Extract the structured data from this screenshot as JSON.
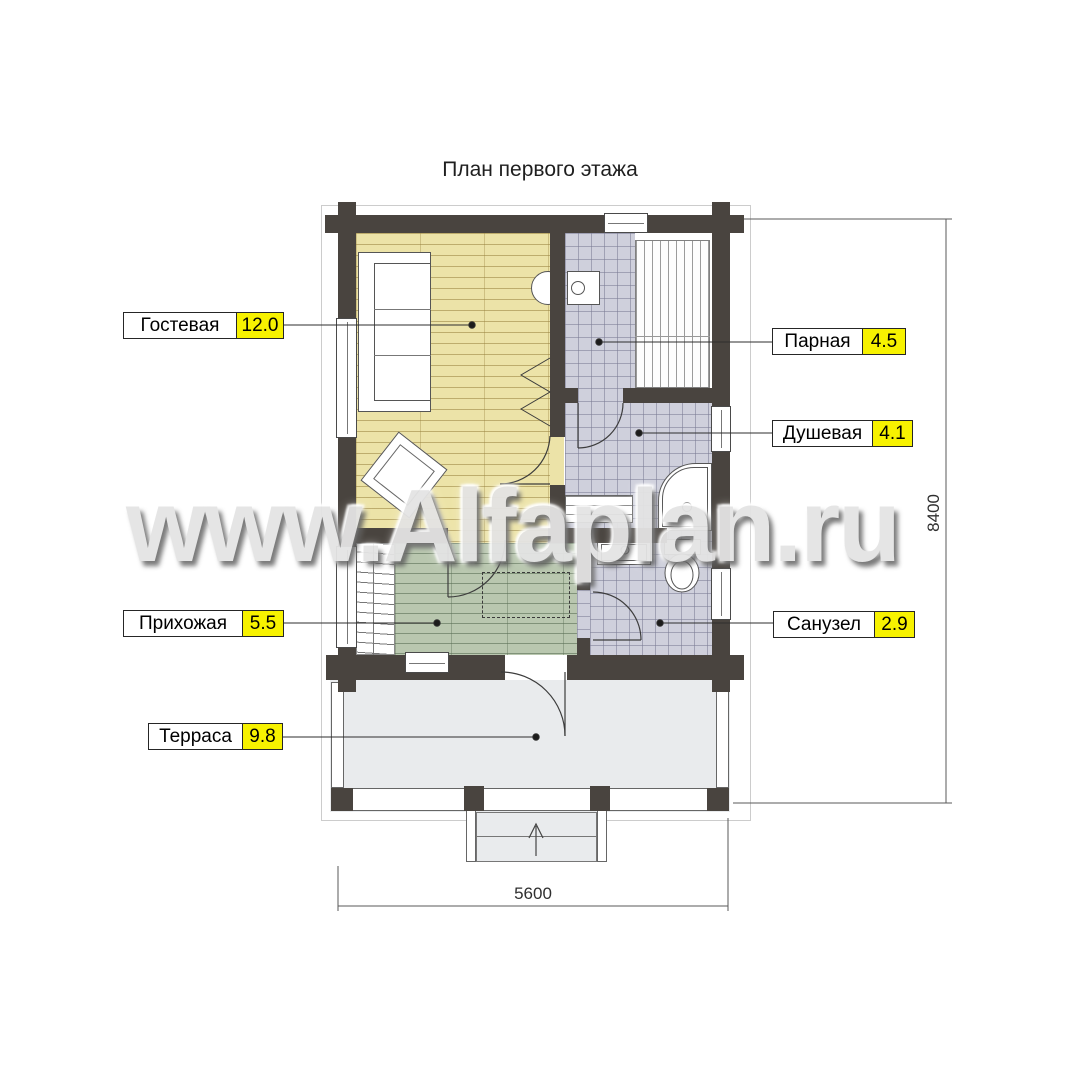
{
  "title": "План первого этажа",
  "watermark": "www.Alfaplan.ru",
  "rooms": [
    {
      "name": "Гостевая",
      "area": "12.0"
    },
    {
      "name": "Парная",
      "area": "4.5"
    },
    {
      "name": "Душевая",
      "area": "4.1"
    },
    {
      "name": "Прихожая",
      "area": "5.5"
    },
    {
      "name": "Санузел",
      "area": "2.9"
    },
    {
      "name": "Терраса",
      "area": "9.8"
    }
  ],
  "dimensions": {
    "width_mm": "5600",
    "height_mm": "8400"
  },
  "colors": {
    "wall": "#49443f",
    "guest_floor": "#ece3a8",
    "hall_floor": "#b9c7af",
    "tile_floor": "#cfd0dc",
    "terrace_floor": "#e9ebed",
    "area_badge": "#f7f200"
  }
}
